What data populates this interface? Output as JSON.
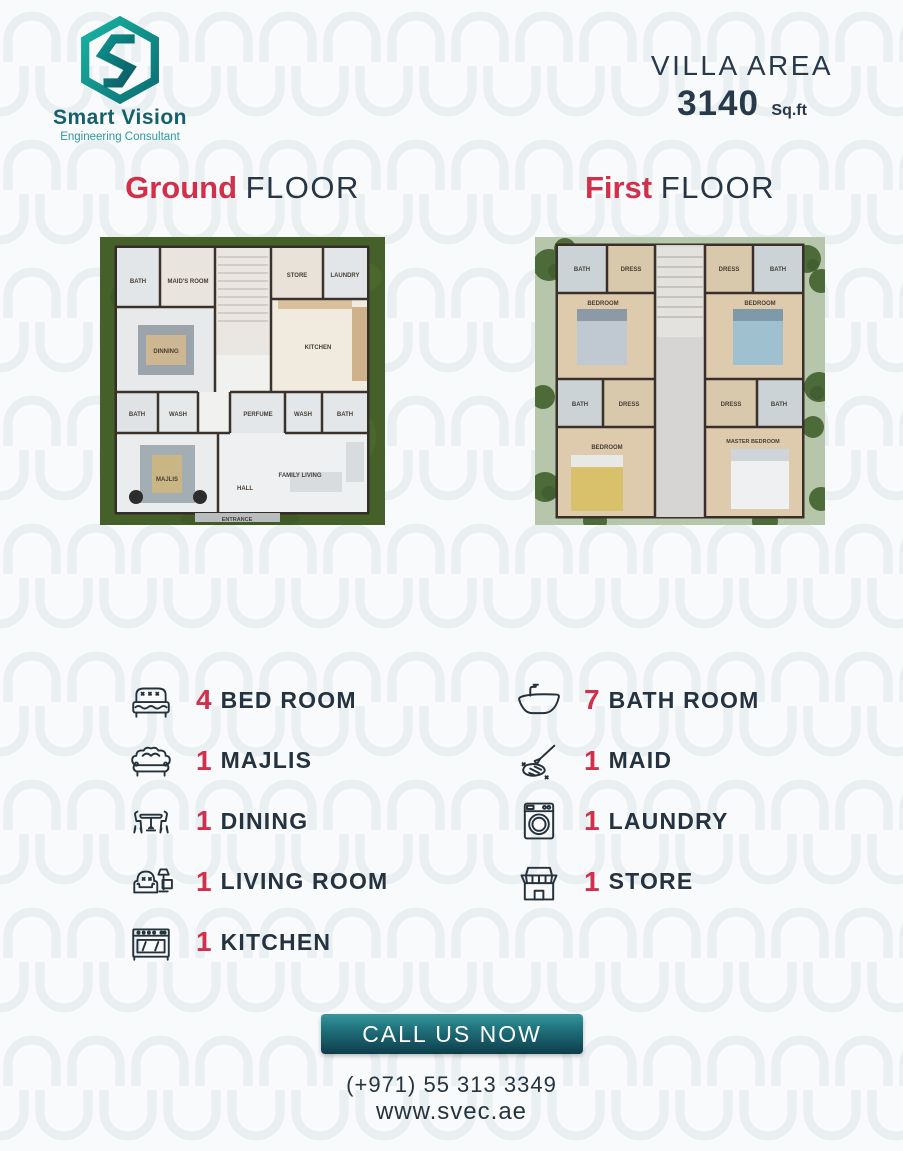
{
  "brand": {
    "name": "Smart Vision",
    "tagline": "Engineering Consultant"
  },
  "villa": {
    "label": "VILLA AREA",
    "area": "3140",
    "unit": "Sq.ft"
  },
  "floors": {
    "ground": {
      "highlight": "Ground",
      "rest": "FLOOR"
    },
    "first": {
      "highlight": "First",
      "rest": "FLOOR"
    }
  },
  "plans": {
    "ground": {
      "rooms": {
        "bath_tl": "BATH",
        "maids_room": "MAID'S ROOM",
        "store": "STORE",
        "laundry": "LAUNDRY",
        "kitchen": "KITCHEN",
        "dining": "DINNING",
        "bath_ml": "BATH",
        "wash_ml": "WASH",
        "perfume": "PERFUME",
        "wash_c": "WASH",
        "bath_mr": "BATH",
        "majlis": "MAJLIS",
        "hall": "HALL",
        "family_living": "FAMILY LIVING",
        "entrance": "ENTRANCE"
      }
    },
    "first": {
      "rooms": {
        "bath_tl": "BATH",
        "dress_tl": "DRESS",
        "dress_tr": "DRESS",
        "bath_tr": "BATH",
        "bedroom_l": "BEDROOM",
        "bedroom_r": "BEDROOM",
        "bath_ml": "BATH",
        "dress_ml": "DRESS",
        "dress_mr": "DRESS",
        "bath_mr": "BATH",
        "bedroom_bl": "BEDROOM",
        "master_bedroom": "MASTER BEDROOM"
      }
    }
  },
  "features": {
    "left": [
      {
        "count": "4",
        "label": "BED ROOM",
        "icon": "bed-icon"
      },
      {
        "count": "1",
        "label": "MAJLIS",
        "icon": "sofa-icon"
      },
      {
        "count": "1",
        "label": "DINING",
        "icon": "dining-table-icon"
      },
      {
        "count": "1",
        "label": "LIVING ROOM",
        "icon": "armchair-tv-icon"
      },
      {
        "count": "1",
        "label": "KITCHEN",
        "icon": "stove-icon"
      }
    ],
    "right": [
      {
        "count": "7",
        "label": "BATH ROOM",
        "icon": "bathtub-icon"
      },
      {
        "count": "1",
        "label": "MAID",
        "icon": "cleaning-icon"
      },
      {
        "count": "1",
        "label": "LAUNDRY",
        "icon": "washing-machine-icon"
      },
      {
        "count": "1",
        "label": "STORE",
        "icon": "storefront-icon"
      }
    ]
  },
  "cta": {
    "button": "CALL US NOW",
    "phone": "(+971) 55 313 3349",
    "website": "www.svec.ae"
  },
  "colors": {
    "accent_red": "#d2304a",
    "navy": "#24333f",
    "teal_dark": "#0e3d4a",
    "teal": "#2b9aa0",
    "grass_green": "#456129",
    "sage_green": "#b5c6ab",
    "pattern": "#e3ebee"
  }
}
